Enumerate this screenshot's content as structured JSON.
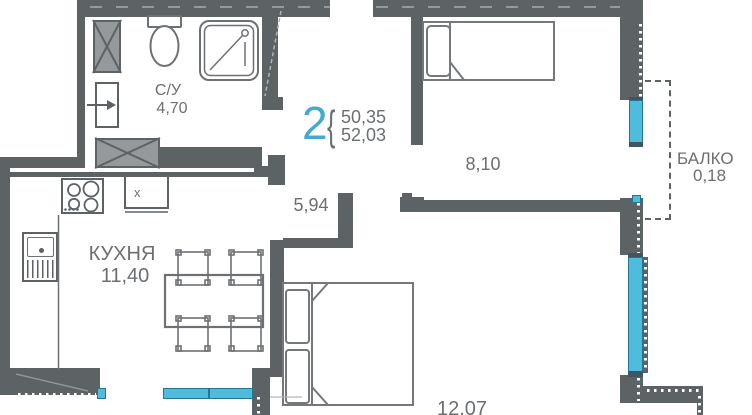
{
  "plan": {
    "title": "apartment-floor-plan",
    "apartment": {
      "rooms_count": "2",
      "bracket": "{",
      "area_living": "50,35",
      "area_total": "52,03"
    },
    "rooms": {
      "bathroom": {
        "name": "С/У",
        "area": "4,70"
      },
      "kitchen": {
        "name": "КУХНЯ",
        "area": "11,40"
      },
      "hall": {
        "area": "5,94"
      },
      "bedroom_top": {
        "area": "8,10"
      },
      "bedroom_bottom": {
        "area": "12,07"
      },
      "balcony": {
        "name": "БАЛКО",
        "area": "0,18"
      }
    },
    "fixtures": {
      "cabinet_mark": "x"
    },
    "colors": {
      "wall": "#5d6265",
      "accent_cyan": "#45a9cf",
      "window_fill": "#4fbbdd",
      "window_border": "#257693",
      "text": "#6b6f72",
      "shaft_fill": "#95999c"
    }
  }
}
